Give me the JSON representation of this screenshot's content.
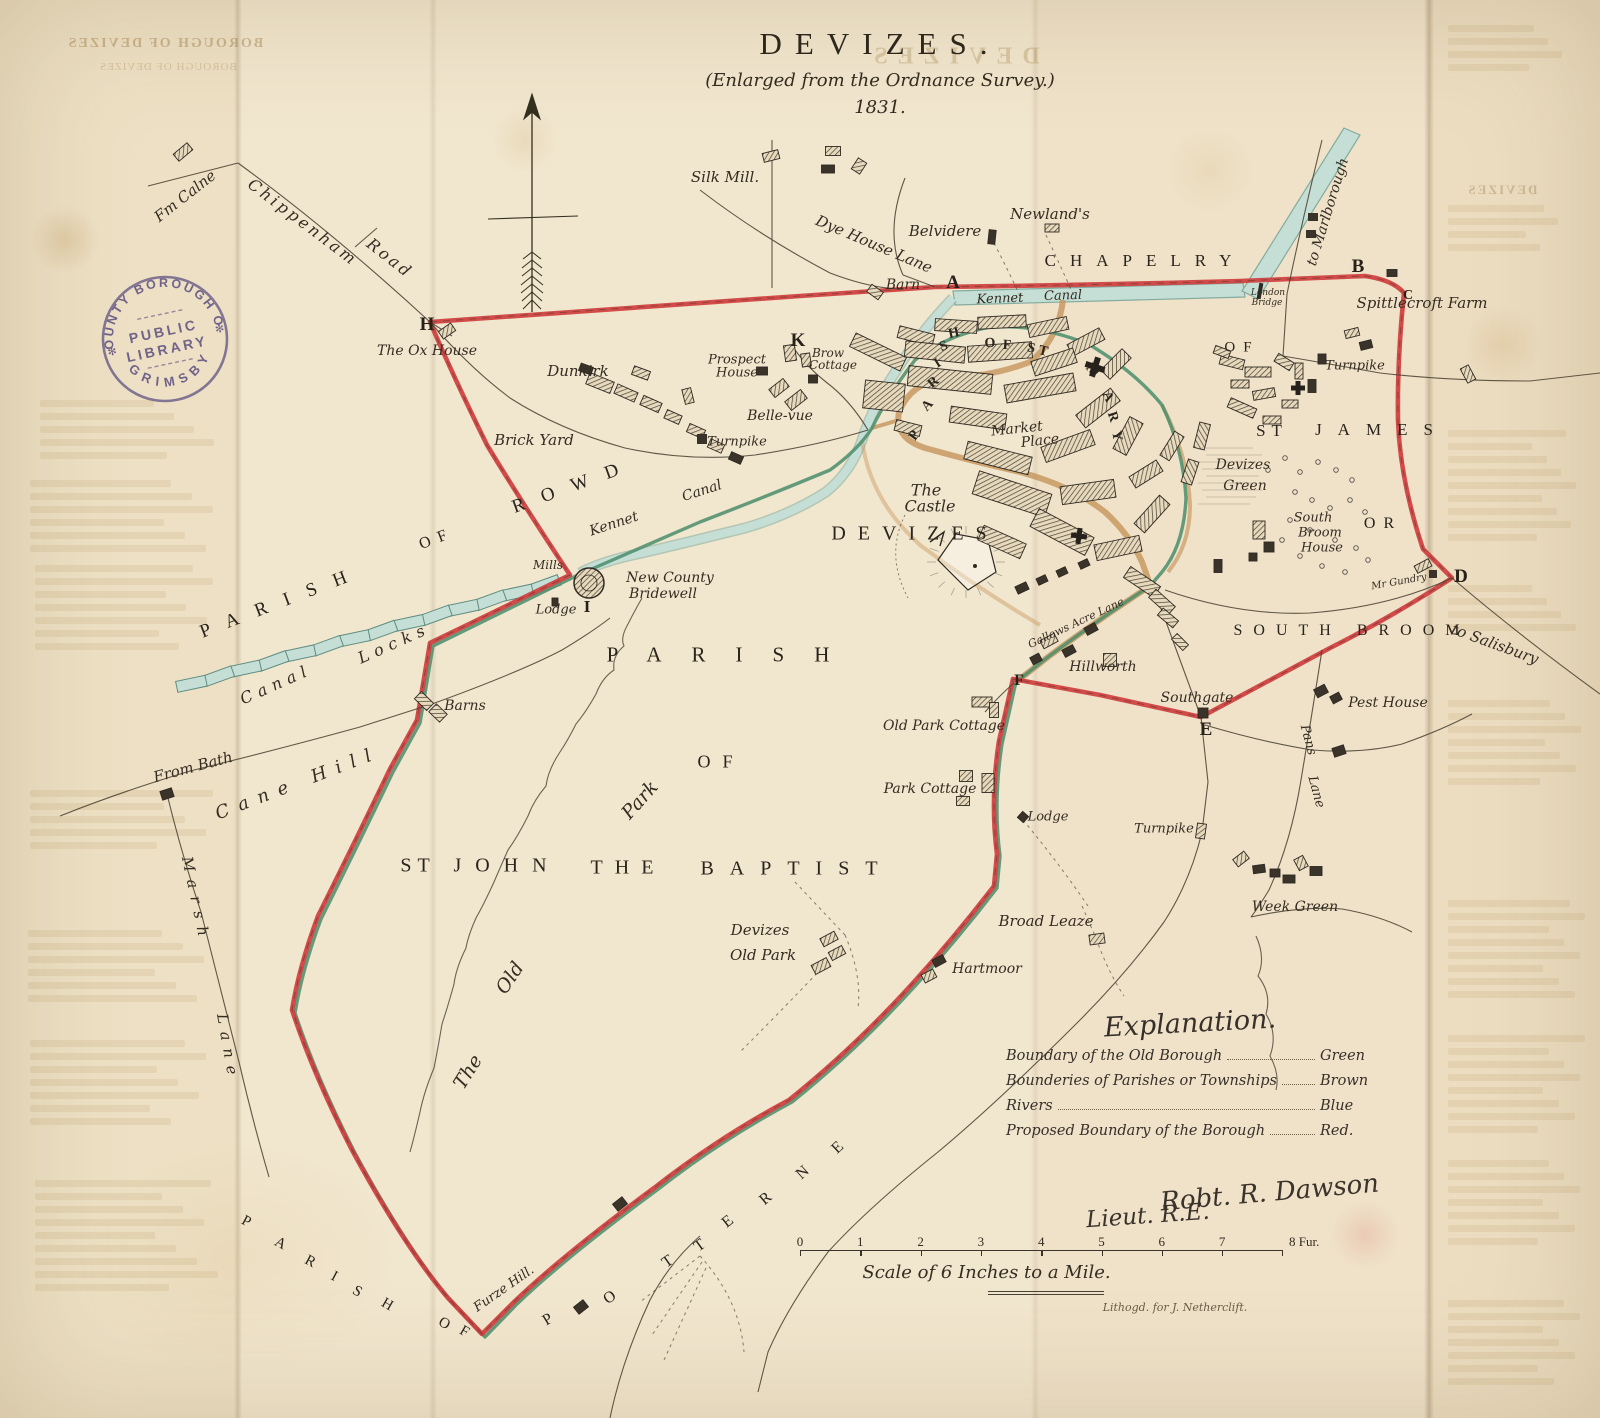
{
  "title": {
    "main": "DEVIZES.",
    "subtitle": "(Enlarged from the Ordnance Survey.)",
    "year": "1831."
  },
  "ghost": {
    "top_left": "BOROUGH OF DEVIZES",
    "title_echo": "DEVIZES"
  },
  "stamp": {
    "arc_top": "COUNTY BOROUGH OF",
    "arc_bottom": "GRIMSBY",
    "center_line1": "PUBLIC",
    "center_line2": "LIBRARY"
  },
  "explanation": {
    "heading": "Explanation.",
    "rows": [
      {
        "label": "Boundary of the Old Borough",
        "value": "Green"
      },
      {
        "label": "Bounderies of Parishes or Townships",
        "value": "Brown"
      },
      {
        "label": "Rivers",
        "value": "Blue"
      },
      {
        "label": "Proposed Boundary of the Borough",
        "value": "Red."
      }
    ],
    "signature_line1": "Robt. R. Dawson",
    "signature_line2": "Lieut. R.E."
  },
  "scale_bar": {
    "ticks": [
      "0",
      "1",
      "2",
      "3",
      "4",
      "5",
      "6",
      "7"
    ],
    "end_label": "8 Fur.",
    "caption": "Scale of 6 Inches to a Mile.",
    "imprint": "Lithogd. for J. Netherclift."
  },
  "colors": {
    "boundary_red": "#cf3e3e",
    "boundary_green": "#4f8f6e",
    "parish_brown": "#c6955c",
    "water_blue": "#c5dfd7",
    "water_edge": "#82ab9e",
    "ink": "#332d24",
    "paper": "#f1e6ce",
    "stamp_purple": "#5b51a3"
  },
  "labels": [
    {
      "t": "Fm Calne",
      "x": 185,
      "y": 196,
      "r": -38,
      "s": 15,
      "c": "i"
    },
    {
      "t": "Chippenham",
      "x": 303,
      "y": 222,
      "r": 37,
      "s": 16,
      "c": "i",
      "ls": 3
    },
    {
      "t": "Road",
      "x": 390,
      "y": 258,
      "r": 38,
      "s": 16,
      "c": "i",
      "ls": 3
    },
    {
      "t": "Silk Mill.",
      "x": 725,
      "y": 177,
      "r": 0,
      "s": 15,
      "c": "i"
    },
    {
      "t": "Dye House Lane",
      "x": 874,
      "y": 244,
      "r": 23,
      "s": 15,
      "c": "i"
    },
    {
      "t": "Belvidere",
      "x": 945,
      "y": 231,
      "r": 0,
      "s": 15,
      "c": "i"
    },
    {
      "t": "Newland's",
      "x": 1050,
      "y": 214,
      "r": 0,
      "s": 15,
      "c": "i"
    },
    {
      "t": "Barn",
      "x": 903,
      "y": 285,
      "r": 0,
      "s": 14,
      "c": "i"
    },
    {
      "t": "CHAPELRY",
      "x": 1145,
      "y": 261,
      "r": 0,
      "s": 17,
      "c": "c",
      "ls": 14
    },
    {
      "t": "to Marlborough",
      "x": 1328,
      "y": 212,
      "r": -73,
      "s": 14,
      "c": "i"
    },
    {
      "t": "Kennet",
      "x": 1000,
      "y": 299,
      "r": -2,
      "s": 13,
      "c": "i"
    },
    {
      "t": "Canal",
      "x": 1063,
      "y": 296,
      "r": -2,
      "s": 13,
      "c": "i"
    },
    {
      "t": "London",
      "x": 1268,
      "y": 293,
      "r": 0,
      "s": 9,
      "c": "s"
    },
    {
      "t": "Bridge",
      "x": 1267,
      "y": 303,
      "r": 0,
      "s": 9,
      "c": "s"
    },
    {
      "t": "Spittlecroft Farm",
      "x": 1422,
      "y": 303,
      "r": 0,
      "s": 15,
      "c": "i"
    },
    {
      "t": "Turnpike",
      "x": 1355,
      "y": 366,
      "r": 0,
      "s": 13,
      "c": "i"
    },
    {
      "t": "OF",
      "x": 1242,
      "y": 348,
      "r": 0,
      "s": 15,
      "c": "c",
      "ls": 8
    },
    {
      "t": "ST",
      "x": 1272,
      "y": 431,
      "r": 0,
      "s": 17,
      "c": "c",
      "ls": 6
    },
    {
      "t": "JAMES",
      "x": 1382,
      "y": 430,
      "r": 0,
      "s": 17,
      "c": "c",
      "ls": 16
    },
    {
      "t": "The Ox House",
      "x": 427,
      "y": 351,
      "r": 0,
      "s": 14,
      "c": "i"
    },
    {
      "t": "Dunkirk",
      "x": 578,
      "y": 371,
      "r": 0,
      "s": 15,
      "c": "i"
    },
    {
      "t": "Brick Yard",
      "x": 534,
      "y": 440,
      "r": 0,
      "s": 15,
      "c": "i"
    },
    {
      "t": "Prospect",
      "x": 737,
      "y": 360,
      "r": 0,
      "s": 13,
      "c": "i"
    },
    {
      "t": "House",
      "x": 737,
      "y": 373,
      "r": 0,
      "s": 13,
      "c": "i"
    },
    {
      "t": "Brow",
      "x": 828,
      "y": 353,
      "r": 0,
      "s": 12,
      "c": "i"
    },
    {
      "t": "Cottage",
      "x": 833,
      "y": 365,
      "r": 0,
      "s": 12,
      "c": "i"
    },
    {
      "t": "Belle-vue",
      "x": 780,
      "y": 416,
      "r": 0,
      "s": 14,
      "c": "i"
    },
    {
      "t": "Turnpike",
      "x": 737,
      "y": 442,
      "r": 0,
      "s": 13,
      "c": "i"
    },
    {
      "t": "PARISH",
      "x": 282,
      "y": 602,
      "r": -21,
      "s": 19,
      "c": "c",
      "ls": 18
    },
    {
      "t": "OF",
      "x": 437,
      "y": 539,
      "r": -21,
      "s": 16,
      "c": "c",
      "ls": 8
    },
    {
      "t": "ROWD",
      "x": 574,
      "y": 486,
      "r": -20,
      "s": 19,
      "c": "c",
      "ls": 18
    },
    {
      "t": "Kennet",
      "x": 614,
      "y": 524,
      "r": -18,
      "s": 14,
      "c": "i"
    },
    {
      "t": "Canal",
      "x": 702,
      "y": 491,
      "r": -18,
      "s": 14,
      "c": "i"
    },
    {
      "t": "Canal",
      "x": 276,
      "y": 684,
      "r": -24,
      "s": 16,
      "c": "i",
      "ls": 6
    },
    {
      "t": "Locks",
      "x": 394,
      "y": 643,
      "r": -24,
      "s": 16,
      "c": "i",
      "ls": 6
    },
    {
      "t": "Mills",
      "x": 548,
      "y": 565,
      "r": 0,
      "s": 12,
      "c": "i"
    },
    {
      "t": "New County",
      "x": 670,
      "y": 578,
      "r": 0,
      "s": 14,
      "c": "i"
    },
    {
      "t": "Bridewell",
      "x": 663,
      "y": 594,
      "r": 0,
      "s": 14,
      "c": "i"
    },
    {
      "t": "Lodge",
      "x": 556,
      "y": 610,
      "r": 0,
      "s": 13,
      "c": "i"
    },
    {
      "t": "Barns",
      "x": 465,
      "y": 706,
      "r": 0,
      "s": 14,
      "c": "i"
    },
    {
      "t": "From Bath",
      "x": 193,
      "y": 767,
      "r": -15,
      "s": 15,
      "c": "i"
    },
    {
      "t": "Cane Hill",
      "x": 298,
      "y": 783,
      "r": -21,
      "s": 18,
      "c": "i",
      "ls": 10
    },
    {
      "t": "Marsh",
      "x": 196,
      "y": 900,
      "r": 78,
      "s": 15,
      "c": "i",
      "ls": 8
    },
    {
      "t": "Lane",
      "x": 228,
      "y": 1048,
      "r": 80,
      "s": 15,
      "c": "i",
      "ls": 8
    },
    {
      "t": "PARISH",
      "x": 733,
      "y": 655,
      "r": 0,
      "s": 21,
      "c": "c",
      "ls": 30
    },
    {
      "t": "OF",
      "x": 721,
      "y": 762,
      "r": 0,
      "s": 18,
      "c": "c",
      "ls": 12
    },
    {
      "t": "ST",
      "x": 418,
      "y": 866,
      "r": 0,
      "s": 20,
      "c": "c",
      "ls": 6
    },
    {
      "t": "JOHN",
      "x": 507,
      "y": 866,
      "r": 0,
      "s": 20,
      "c": "c",
      "ls": 14
    },
    {
      "t": "THE",
      "x": 628,
      "y": 868,
      "r": 0,
      "s": 20,
      "c": "c",
      "ls": 12
    },
    {
      "t": "BAPTIST",
      "x": 797,
      "y": 869,
      "r": 0,
      "s": 20,
      "c": "c",
      "ls": 16
    },
    {
      "t": "The",
      "x": 468,
      "y": 1072,
      "r": -58,
      "s": 19,
      "c": "i"
    },
    {
      "t": "Old",
      "x": 510,
      "y": 978,
      "r": -56,
      "s": 19,
      "c": "i"
    },
    {
      "t": "Park",
      "x": 640,
      "y": 800,
      "r": -48,
      "s": 19,
      "c": "i"
    },
    {
      "t": "Devizes",
      "x": 760,
      "y": 930,
      "r": 0,
      "s": 15,
      "c": "i"
    },
    {
      "t": "Old Park",
      "x": 763,
      "y": 955,
      "r": 0,
      "s": 15,
      "c": "i"
    },
    {
      "t": "Hartmoor",
      "x": 987,
      "y": 969,
      "r": 0,
      "s": 14,
      "c": "i"
    },
    {
      "t": "Broad Leaze",
      "x": 1046,
      "y": 921,
      "r": 0,
      "s": 15,
      "c": "i"
    },
    {
      "t": "Old Park Cottage",
      "x": 944,
      "y": 726,
      "r": 0,
      "s": 14,
      "c": "i"
    },
    {
      "t": "Park Cottage",
      "x": 930,
      "y": 789,
      "r": 0,
      "s": 14,
      "c": "i"
    },
    {
      "t": "Lodge",
      "x": 1048,
      "y": 817,
      "r": 0,
      "s": 13,
      "c": "i"
    },
    {
      "t": "Turnpike",
      "x": 1164,
      "y": 829,
      "r": 0,
      "s": 13,
      "c": "i"
    },
    {
      "t": "Week Green",
      "x": 1295,
      "y": 907,
      "r": 0,
      "s": 14,
      "c": "i"
    },
    {
      "t": "Pans",
      "x": 1308,
      "y": 740,
      "r": 75,
      "s": 13,
      "c": "i"
    },
    {
      "t": "Lane",
      "x": 1316,
      "y": 792,
      "r": 75,
      "s": 13,
      "c": "i"
    },
    {
      "t": "Pest House",
      "x": 1388,
      "y": 703,
      "r": 0,
      "s": 14,
      "c": "i"
    },
    {
      "t": "Hillworth",
      "x": 1103,
      "y": 667,
      "r": 0,
      "s": 14,
      "c": "i"
    },
    {
      "t": "Southgate",
      "x": 1197,
      "y": 698,
      "r": 0,
      "s": 14,
      "c": "i"
    },
    {
      "t": "Gallows Acre Lane",
      "x": 1076,
      "y": 623,
      "r": -25,
      "s": 11,
      "c": "s"
    },
    {
      "t": "SOUTH BROOM",
      "x": 1352,
      "y": 631,
      "r": 0,
      "s": 16,
      "c": "c",
      "ls": 11
    },
    {
      "t": "to Salisbury",
      "x": 1495,
      "y": 644,
      "r": 20,
      "s": 15,
      "c": "i"
    },
    {
      "t": "Devizes",
      "x": 1243,
      "y": 465,
      "r": 0,
      "s": 14,
      "c": "i"
    },
    {
      "t": "Green",
      "x": 1245,
      "y": 486,
      "r": 0,
      "s": 14,
      "c": "i"
    },
    {
      "t": "South",
      "x": 1313,
      "y": 518,
      "r": 0,
      "s": 13,
      "c": "i"
    },
    {
      "t": "Broom",
      "x": 1320,
      "y": 533,
      "r": 0,
      "s": 13,
      "c": "i"
    },
    {
      "t": "House",
      "x": 1322,
      "y": 548,
      "r": 0,
      "s": 13,
      "c": "i"
    },
    {
      "t": "OR",
      "x": 1383,
      "y": 524,
      "r": 0,
      "s": 16,
      "c": "c",
      "ls": 8
    },
    {
      "t": "Mr Gundry",
      "x": 1399,
      "y": 582,
      "r": -10,
      "s": 10,
      "c": "s"
    },
    {
      "t": "The",
      "x": 926,
      "y": 490,
      "r": 0,
      "s": 16,
      "c": "i"
    },
    {
      "t": "Castle",
      "x": 930,
      "y": 506,
      "r": 0,
      "s": 16,
      "c": "i"
    },
    {
      "t": "DEVIZES",
      "x": 915,
      "y": 534,
      "r": 0,
      "s": 20,
      "c": "c",
      "ls": 12
    },
    {
      "t": "Market",
      "x": 1017,
      "y": 429,
      "r": -6,
      "s": 14,
      "c": "i"
    },
    {
      "t": "Place",
      "x": 1040,
      "y": 441,
      "r": -6,
      "s": 14,
      "c": "i"
    },
    {
      "t": "Furze Hill.",
      "x": 504,
      "y": 1289,
      "r": -35,
      "s": 13,
      "c": "i"
    },
    {
      "t": "A",
      "x": 953,
      "y": 283,
      "r": 0,
      "s": 19,
      "c": "L"
    },
    {
      "t": "B",
      "x": 1358,
      "y": 267,
      "r": 0,
      "s": 19,
      "c": "L"
    },
    {
      "t": "C",
      "x": 1408,
      "y": 296,
      "r": 0,
      "s": 14,
      "c": "L"
    },
    {
      "t": "D",
      "x": 1461,
      "y": 577,
      "r": 0,
      "s": 19,
      "c": "L"
    },
    {
      "t": "E",
      "x": 1206,
      "y": 730,
      "r": 0,
      "s": 19,
      "c": "L"
    },
    {
      "t": "F",
      "x": 1019,
      "y": 681,
      "r": 0,
      "s": 16,
      "c": "L"
    },
    {
      "t": "H",
      "x": 427,
      "y": 325,
      "r": 0,
      "s": 19,
      "c": "L"
    },
    {
      "t": "I",
      "x": 587,
      "y": 607,
      "r": 0,
      "s": 17,
      "c": "L"
    },
    {
      "t": "K",
      "x": 798,
      "y": 341,
      "r": 0,
      "s": 19,
      "c": "L"
    },
    {
      "t": "P",
      "x": 915,
      "y": 436,
      "r": -55,
      "s": 14,
      "c": "m"
    },
    {
      "t": "A",
      "x": 928,
      "y": 406,
      "r": -48,
      "s": 14,
      "c": "m"
    },
    {
      "t": "R",
      "x": 934,
      "y": 383,
      "r": -40,
      "s": 14,
      "c": "m"
    },
    {
      "t": "I",
      "x": 938,
      "y": 364,
      "r": -32,
      "s": 14,
      "c": "m"
    },
    {
      "t": "S",
      "x": 944,
      "y": 347,
      "r": -22,
      "s": 14,
      "c": "m"
    },
    {
      "t": "H",
      "x": 954,
      "y": 334,
      "r": -12,
      "s": 14,
      "c": "m"
    },
    {
      "t": "O",
      "x": 990,
      "y": 344,
      "r": -2,
      "s": 14,
      "c": "m"
    },
    {
      "t": "F",
      "x": 1007,
      "y": 346,
      "r": 4,
      "s": 14,
      "c": "m"
    },
    {
      "t": "S",
      "x": 1031,
      "y": 349,
      "r": 12,
      "s": 14,
      "c": "m"
    },
    {
      "t": "T",
      "x": 1043,
      "y": 352,
      "r": 14,
      "s": 14,
      "c": "m"
    },
    {
      "t": "M",
      "x": 1092,
      "y": 371,
      "r": 48,
      "s": 14,
      "c": "m"
    },
    {
      "t": "A",
      "x": 1107,
      "y": 397,
      "r": 62,
      "s": 14,
      "c": "m"
    },
    {
      "t": "R",
      "x": 1112,
      "y": 417,
      "r": 72,
      "s": 14,
      "c": "m"
    },
    {
      "t": "Y",
      "x": 1116,
      "y": 436,
      "r": 80,
      "s": 14,
      "c": "m"
    },
    {
      "t": "P",
      "x": 548,
      "y": 1320,
      "r": -32,
      "s": 16,
      "c": "c"
    },
    {
      "t": "O",
      "x": 610,
      "y": 1298,
      "r": -34,
      "s": 16,
      "c": "c"
    },
    {
      "t": "T",
      "x": 668,
      "y": 1262,
      "r": -35,
      "s": 16,
      "c": "c"
    },
    {
      "t": "T",
      "x": 700,
      "y": 1246,
      "r": -36,
      "s": 16,
      "c": "c"
    },
    {
      "t": "E",
      "x": 728,
      "y": 1222,
      "r": -38,
      "s": 16,
      "c": "c"
    },
    {
      "t": "R",
      "x": 766,
      "y": 1199,
      "r": -40,
      "s": 16,
      "c": "c"
    },
    {
      "t": "N",
      "x": 803,
      "y": 1173,
      "r": -42,
      "s": 16,
      "c": "c"
    },
    {
      "t": "E",
      "x": 838,
      "y": 1148,
      "r": -43,
      "s": 16,
      "c": "c"
    },
    {
      "t": "P",
      "x": 246,
      "y": 1222,
      "r": 28,
      "s": 15,
      "c": "c"
    },
    {
      "t": "A",
      "x": 280,
      "y": 1244,
      "r": 28,
      "s": 15,
      "c": "c"
    },
    {
      "t": "R",
      "x": 310,
      "y": 1262,
      "r": 28,
      "s": 15,
      "c": "c"
    },
    {
      "t": "I",
      "x": 334,
      "y": 1277,
      "r": 28,
      "s": 15,
      "c": "c"
    },
    {
      "t": "S",
      "x": 357,
      "y": 1292,
      "r": 30,
      "s": 15,
      "c": "c"
    },
    {
      "t": "H",
      "x": 387,
      "y": 1305,
      "r": 30,
      "s": 15,
      "c": "c"
    },
    {
      "t": "O",
      "x": 444,
      "y": 1324,
      "r": 30,
      "s": 15,
      "c": "c"
    },
    {
      "t": "F",
      "x": 464,
      "y": 1332,
      "r": 30,
      "s": 15,
      "c": "c"
    }
  ]
}
